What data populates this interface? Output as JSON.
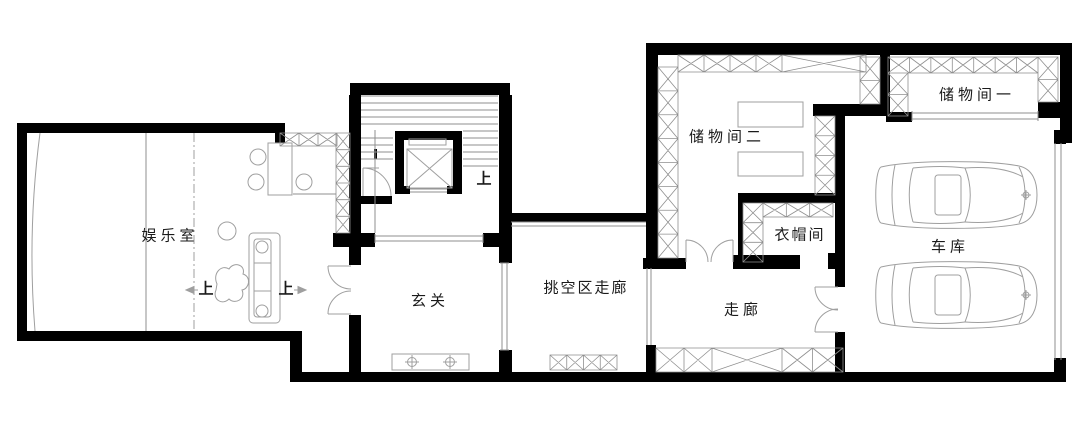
{
  "plan": {
    "type": "architectural-floor-plan",
    "rooms": [
      {
        "id": "entertainment-room",
        "label": "娱乐室"
      },
      {
        "id": "foyer",
        "label": "玄关"
      },
      {
        "id": "void-corridor",
        "label": "挑空区走廊"
      },
      {
        "id": "corridor",
        "label": "走廊"
      },
      {
        "id": "cloakroom",
        "label": "衣帽间"
      },
      {
        "id": "storage-room-2",
        "label": "储物间二"
      },
      {
        "id": "storage-room-1",
        "label": "储物间一"
      },
      {
        "id": "garage",
        "label": "车库"
      }
    ],
    "direction_markers": [
      {
        "id": "up-stairs",
        "label": "上"
      },
      {
        "id": "up-ramp-left",
        "label": "上"
      },
      {
        "id": "up-ramp-right",
        "label": "上"
      }
    ],
    "colors": {
      "wall": "#000000",
      "hatch_line": "#8f8f8f",
      "thin_line": "#8f8f8f",
      "furniture_line": "#9f9f9f",
      "label": "#1a1a1a",
      "background": "#ffffff"
    }
  }
}
